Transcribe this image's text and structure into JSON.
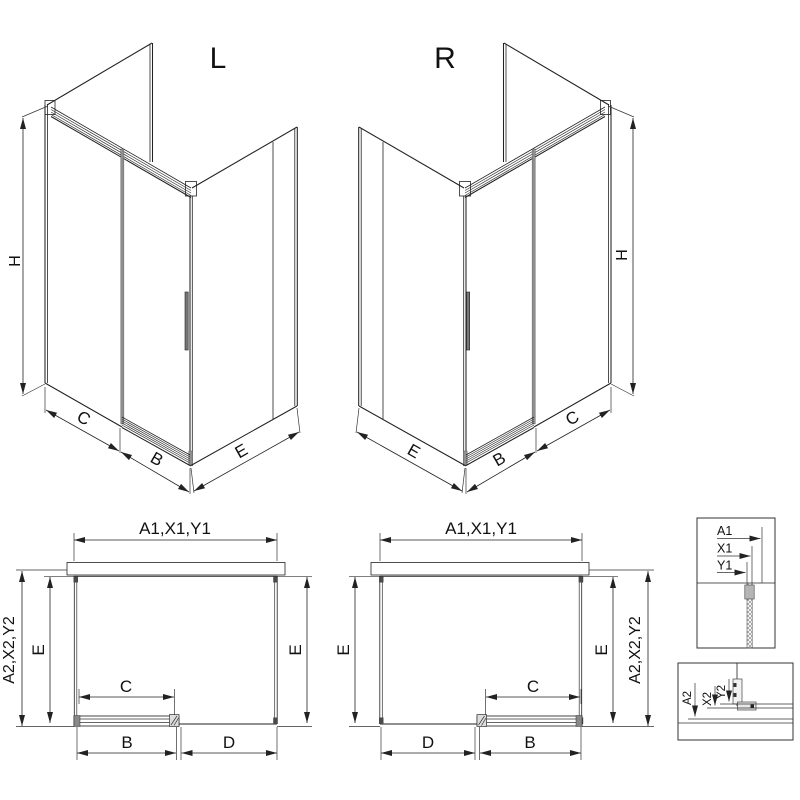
{
  "drawing": {
    "iso_left": {
      "label": "L",
      "height_dim": "H",
      "front_fixed_dim": "C",
      "door_dim": "B",
      "side_dim": "E"
    },
    "iso_right": {
      "label": "R",
      "height_dim": "H",
      "front_fixed_dim": "C",
      "door_dim": "B",
      "side_dim": "E"
    },
    "plan_left": {
      "width_dim": "A1,X1,Y1",
      "depth_overall_dim": "A2,X2,Y2",
      "depth_left_dim": "E",
      "depth_right_dim": "E",
      "opening_dim": "C",
      "door_dim": "B",
      "fixed_dim": "D"
    },
    "plan_right": {
      "width_dim": "A1,X1,Y1",
      "depth_overall_dim": "A2,X2,Y2",
      "depth_left_dim": "E",
      "depth_right_dim": "E",
      "opening_dim": "C",
      "door_dim": "B",
      "fixed_dim": "D"
    },
    "detail_width_refs": {
      "labels": [
        "A1",
        "X1",
        "Y1"
      ]
    },
    "detail_depth_refs": {
      "labels": [
        "A2",
        "X2",
        "Y2"
      ]
    },
    "colors": {
      "line": "#222222",
      "profile_gray": "#8f8f8f",
      "text": "#111111",
      "background": "#ffffff"
    }
  }
}
